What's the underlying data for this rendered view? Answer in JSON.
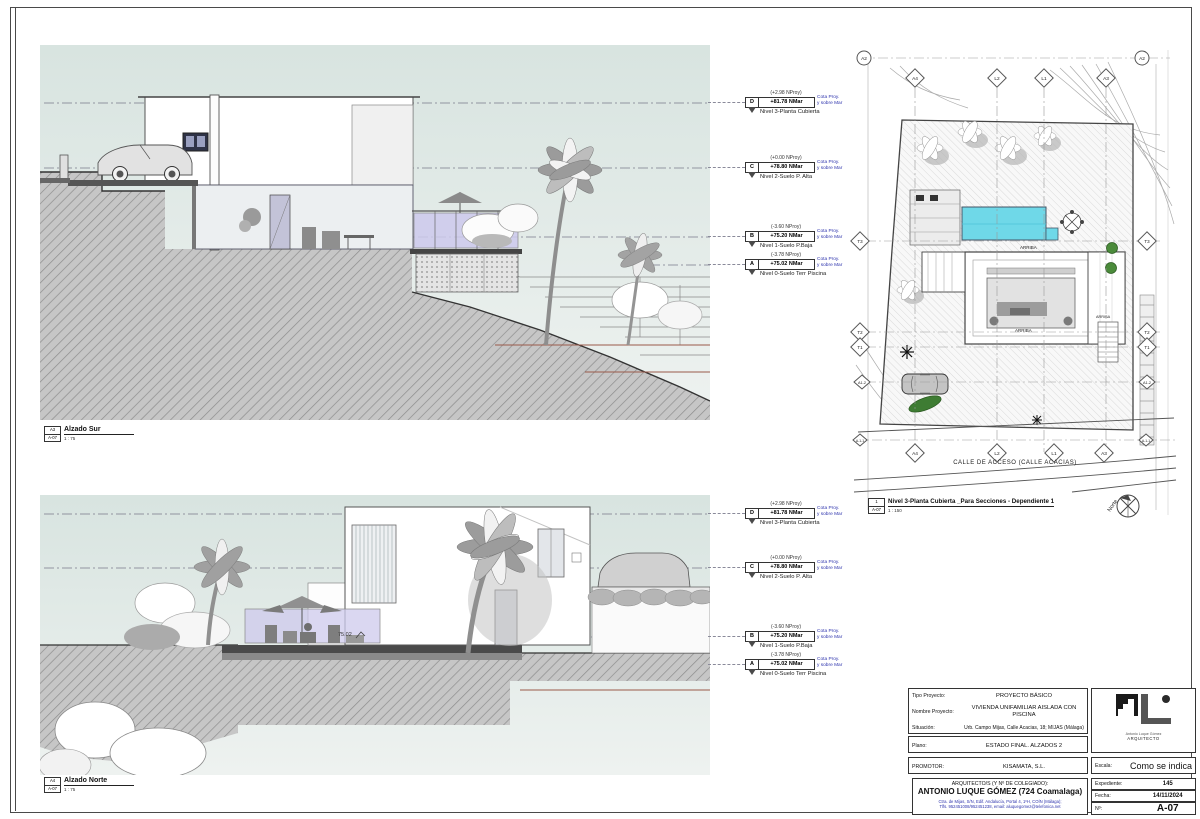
{
  "views": {
    "sur": {
      "tag": "A3",
      "sheet": "A-07",
      "title": "Alzado Sur",
      "scale": "1 : 75"
    },
    "norte": {
      "tag": "A4",
      "sheet": "A-07",
      "title": "Alzado Norte",
      "scale": "1 : 75"
    },
    "planta": {
      "tag": "1",
      "sheet": "A-07",
      "title": "Nivel 3-Planta Cubierta _Para Secciones - Dependiente 1",
      "scale": "1 : 150"
    }
  },
  "levels": {
    "cota_line1": "Cota Proy.",
    "cota_line2": "y sobre Mar",
    "items": [
      {
        "tag": "D",
        "nproy": "(+2.98 NProy)",
        "nmar": "+81.78 NMar",
        "name": "Nivel 3-Planta Cubierta"
      },
      {
        "tag": "C",
        "nproy": "(+0.00 NProy)",
        "nmar": "+78.80 NMar",
        "name": "Nivel 2-Suelo P. Alta"
      },
      {
        "tag": "B",
        "nproy": "(-3.60 NProy)",
        "nmar": "+75.20 NMar",
        "name": "Nivel 1-Suelo P.Baja"
      },
      {
        "tag": "A",
        "nproy": "(-3.78 NProy)",
        "nmar": "+75.02 NMar",
        "name": "Nivel 0-Suelo Terr Piscina"
      }
    ]
  },
  "site": {
    "grid": {
      "a2": "A2",
      "a4": "A4",
      "l2": "L2",
      "l1": "L1",
      "a3": "A3",
      "t3": "T3",
      "t2": "T2",
      "t1": "T1",
      "a12": "A1-2",
      "a11": "A-1-1"
    },
    "street": "CALLE DE ACCESO (CALLE ACACIAS)",
    "arriba": "ARRIBA",
    "north": "Norte"
  },
  "annotations": {
    "spot_elevation": "75.02"
  },
  "titleblock": {
    "tipo_label": "Tipo Proyecto:",
    "tipo": "PROYECTO BÁSICO",
    "nombre_label": "Nombre Proyecto:",
    "nombre": "VIVIENDA UNIFAMILIAR AISLADA CON PISCINA",
    "situacion_label": "Situación:",
    "situacion": "Urb. Campo Mijas, Calle Acacias, 18; MIJAS (Málaga)",
    "plano_label": "Plano:",
    "plano": "ESTADO FINAL. ALZADOS 2",
    "promotor_label": "PROMOTOR:",
    "promotor": "KISAMATA, S.L.",
    "arquitecto_label": "ARQUITECTO/S (Y Nº DE COLEGIADO):",
    "arquitecto": "ANTONIO LUQUE GÓMEZ (724 Coamalaga)",
    "direccion1": "Ctra. de Mijas, S/N, Edif. Andalucía, Portal 4, 1ºH, COÍN (Málaga);",
    "direccion2": "Tlfs. 952451008/952451238, email: aluquegomez@telefonica.net",
    "escala_label": "Escala:",
    "escala": "Como se indica",
    "expediente_label": "Expediente:",
    "expediente": "145",
    "fecha_label": "Fecha:",
    "fecha": "14/11/2024",
    "numero_label": "Nº:",
    "numero": "A-07",
    "logo_name": "Antonio Luque Gómez",
    "logo_title": "ARQUITECTO"
  },
  "colors": {
    "pool": "#6fd8e8",
    "glass": "#cdc9ec",
    "accent_line": "#9a5a4a",
    "annotation_blue": "#2e34ad"
  }
}
